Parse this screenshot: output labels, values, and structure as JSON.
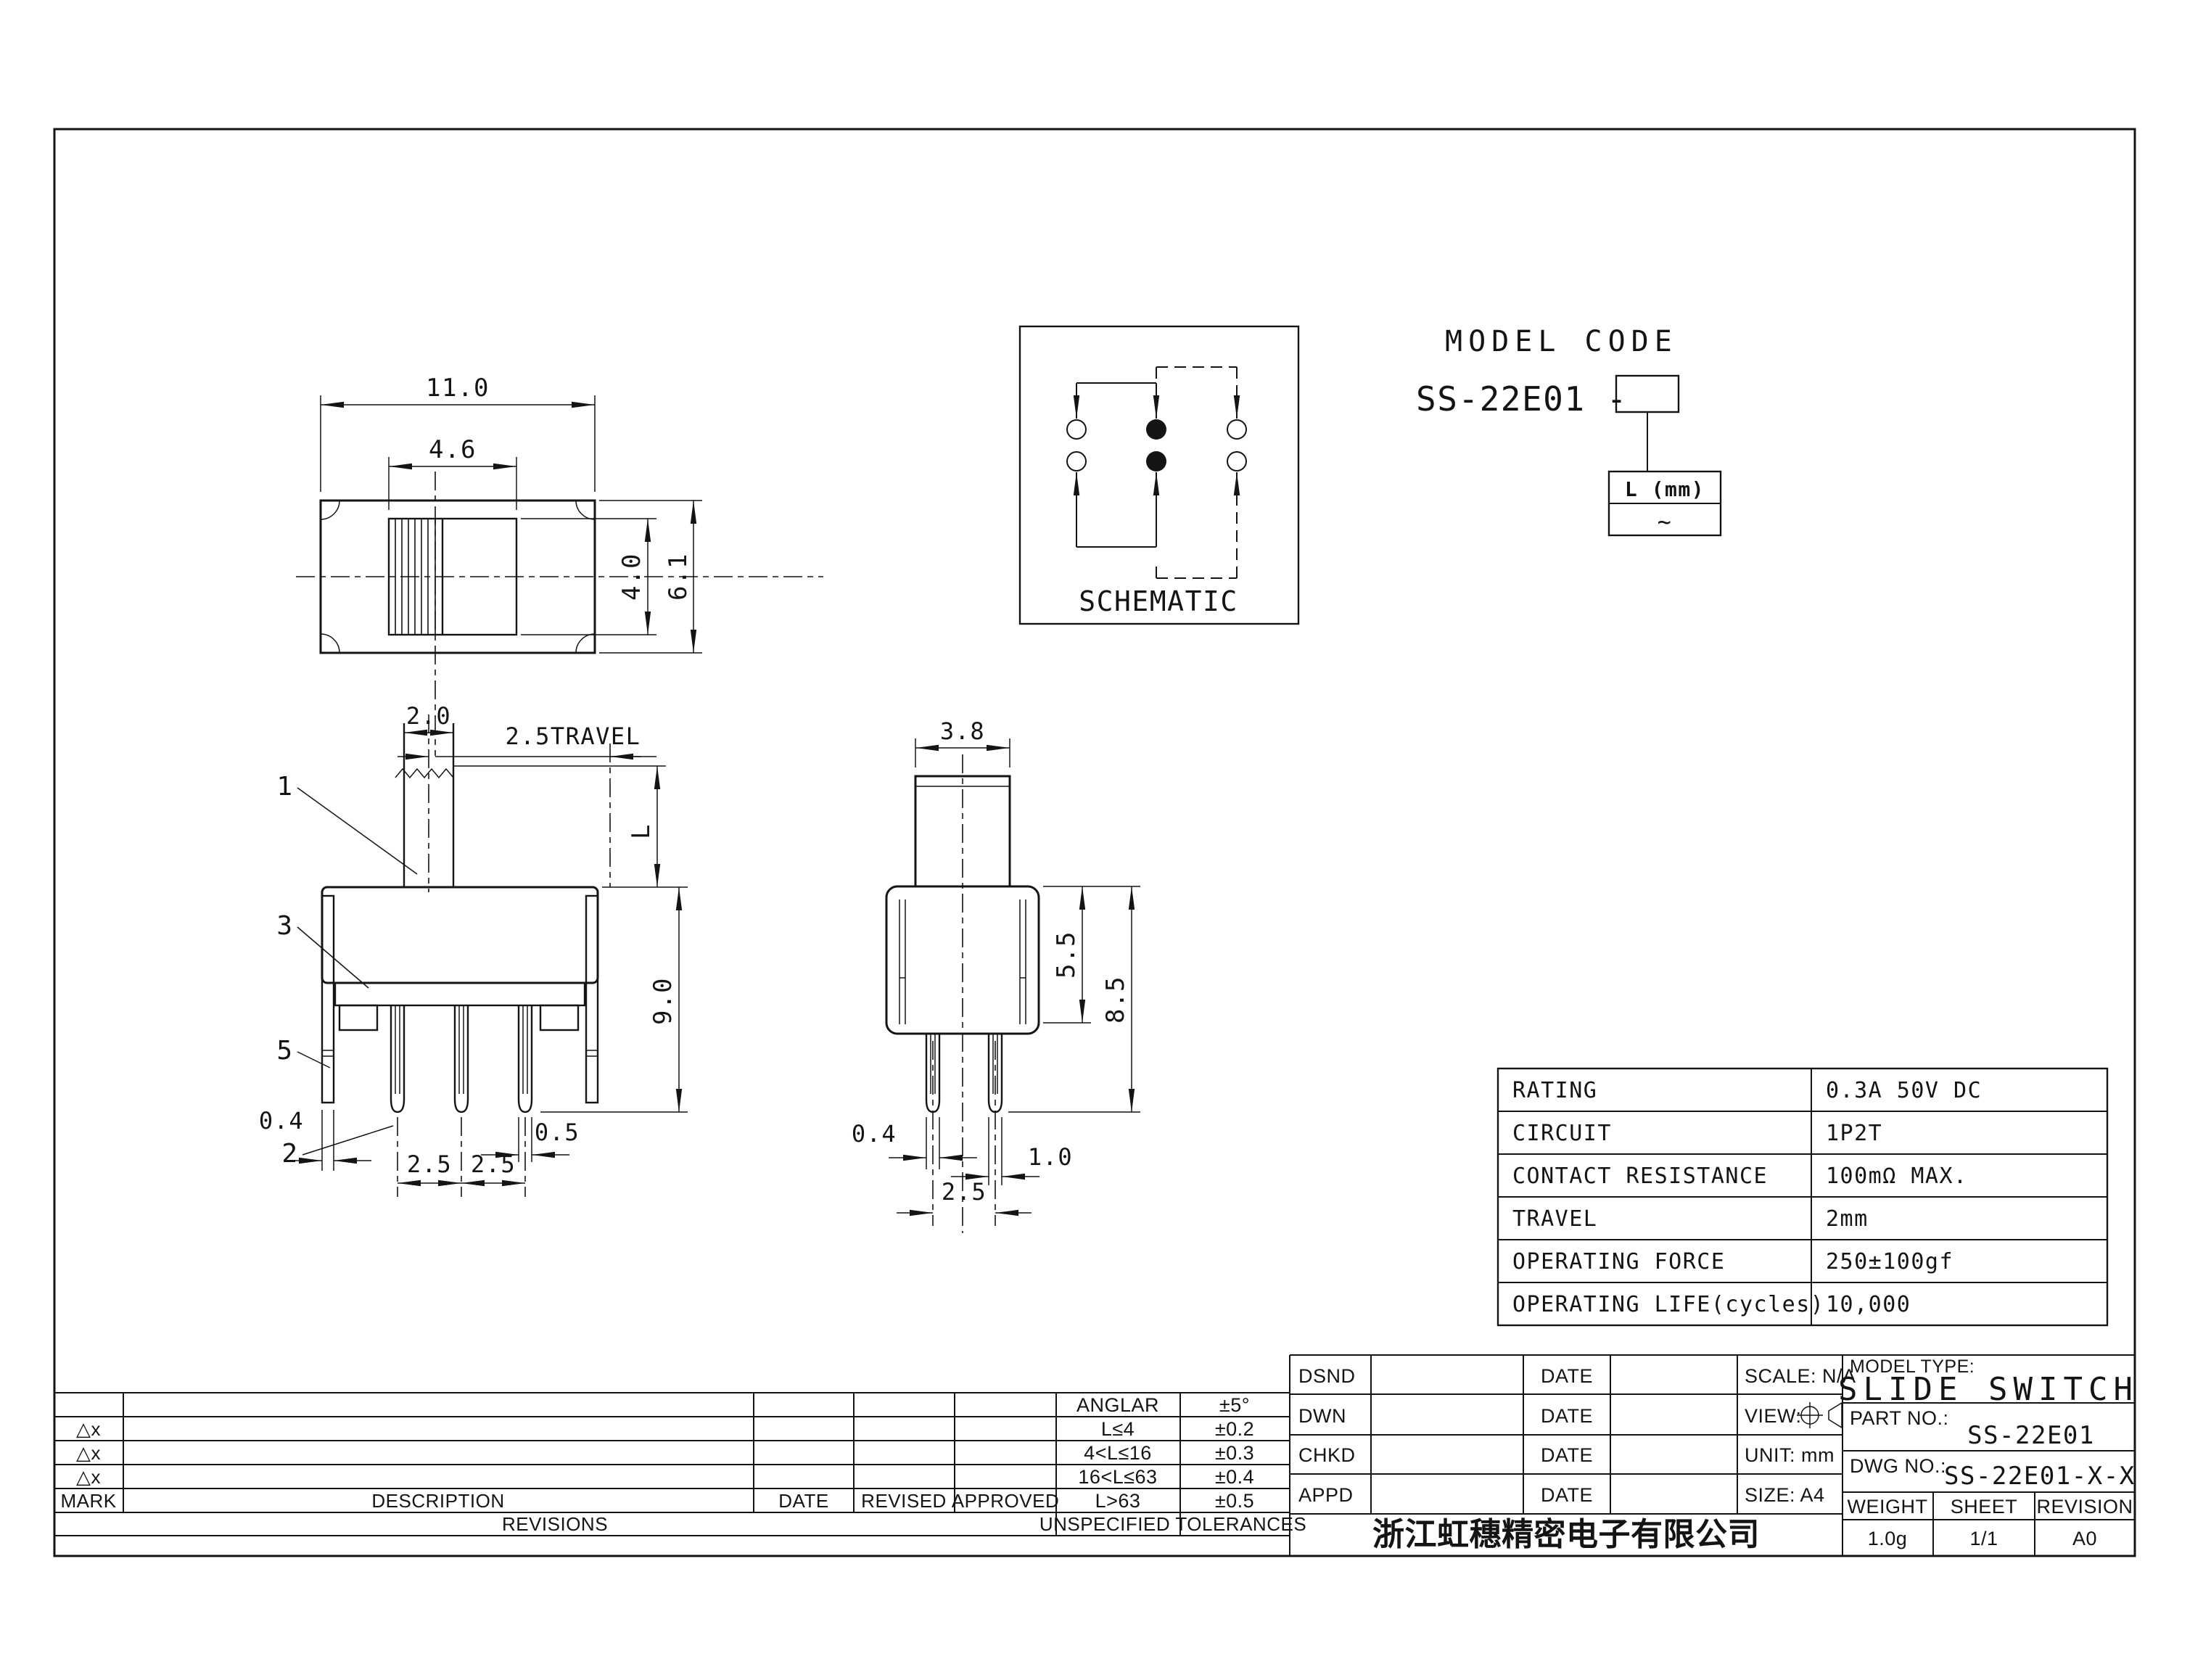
{
  "views": {
    "top": {
      "dim_width": "11.0",
      "dim_knob_width": "4.6",
      "dim_knob_height": "4.0",
      "dim_body_height": "6.1"
    },
    "front": {
      "dim_stem_width": "2.0",
      "dim_travel": "2.5TRAVEL",
      "dim_shaft_length": "L",
      "dim_height": "9.0",
      "dim_bracket_thickness": "0.4",
      "dim_terminal_width": "0.5",
      "dim_pitch_a": "2.5",
      "dim_pitch_b": "2.5",
      "callout_1": "1",
      "callout_3": "3",
      "callout_5": "5",
      "callout_2": "2"
    },
    "side": {
      "dim_knob_width": "3.8",
      "dim_case_height": "5.5",
      "dim_overall_height": "8.5",
      "dim_terminal_thickness": "0.4",
      "dim_terminal_width": "1.0",
      "dim_pitch": "2.5"
    }
  },
  "schematic": {
    "title": "SCHEMATIC"
  },
  "model_code": {
    "heading": "MODEL CODE",
    "code_prefix": "SS-22E01 -",
    "suffix_label": "L (mm)",
    "suffix_value": "~"
  },
  "spec_table": {
    "rows": [
      {
        "label": "RATING",
        "value": "0.3A 50V DC"
      },
      {
        "label": "CIRCUIT",
        "value": "1P2T"
      },
      {
        "label": "CONTACT RESISTANCE",
        "value": "100mΩ MAX."
      },
      {
        "label": "TRAVEL",
        "value": "2mm"
      },
      {
        "label": "OPERATING FORCE",
        "value": "250±100gf"
      },
      {
        "label": "OPERATING LIFE(cycles)",
        "value": "10,000"
      }
    ]
  },
  "title_block": {
    "tolerances": {
      "header": "UNSPECIFIED TOLERANCES",
      "mark_symbol": "△x",
      "rows": [
        {
          "range": "ANGLAR",
          "value": "±5°"
        },
        {
          "range": "L≤4",
          "value": "±0.2"
        },
        {
          "range": "4<L≤16",
          "value": "±0.3"
        },
        {
          "range": "16<L≤63",
          "value": "±0.4"
        },
        {
          "range": "L>63",
          "value": "±0.5"
        }
      ]
    },
    "revisions": {
      "label": "REVISIONS",
      "mark": "MARK",
      "description": "DESCRIPTION",
      "date": "DATE",
      "revised": "REVISED",
      "approved": "APPROVED"
    },
    "signoff": {
      "rows": [
        {
          "role": "DSND",
          "date": "DATE",
          "extra": "SCALE: N/A"
        },
        {
          "role": "DWN",
          "date": "DATE",
          "extra": "VIEW:"
        },
        {
          "role": "CHKD",
          "date": "DATE",
          "extra": "UNIT: mm"
        },
        {
          "role": "APPD",
          "date": "DATE",
          "extra": "SIZE: A4"
        }
      ]
    },
    "company": "浙江虹穗精密电子有限公司",
    "product": {
      "model_type_label": "MODEL TYPE:",
      "model_type": "SLIDE SWITCH",
      "part_label": "PART NO.:",
      "part": "SS-22E01",
      "dwg_label": "DWG NO.:",
      "dwg": "SS-22E01-X-X"
    },
    "footer": {
      "weight_label": "WEIGHT",
      "weight": "1.0g",
      "sheet_label": "SHEET",
      "sheet": "1/1",
      "revision_label": "REVISION",
      "revision": "A0"
    }
  }
}
